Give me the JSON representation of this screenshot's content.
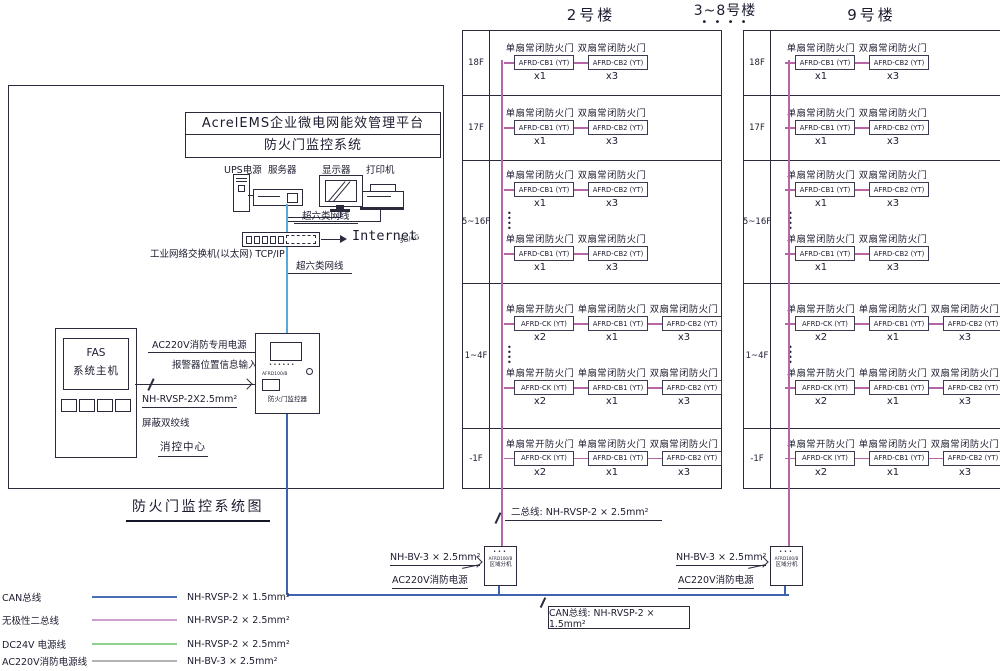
{
  "headers": {
    "building2": "2号楼",
    "building3_8": "3~8号楼",
    "building3_8_dots": "• • • •",
    "building9": "9号楼"
  },
  "platform": {
    "line1": "AcrelEMS企业微电网能效管理平台",
    "line2": "防火门监控系统"
  },
  "devices": {
    "ups": "UPS电源",
    "server": "服务器",
    "display": "显示器",
    "printer": "打印机"
  },
  "network": {
    "cat6_upper": "超六类网线",
    "cat6_lower": "超六类网线",
    "switch_label": "工业网络交换机(以太网) TCP/IP",
    "internet": "Internet",
    "cellular": "3G/4G"
  },
  "fas": {
    "line1": "FAS",
    "line2": "系统主机"
  },
  "controller": {
    "model": "AFRD100/B",
    "name": "防火门监控器"
  },
  "left_labels": {
    "ac220_dedicated": "AC220V消防专用电源",
    "alarm_input": "报警器位置信息输入",
    "cable": "NH-RVSP-2X2.5mm²",
    "shielded": "屏蔽双绞线",
    "fire_center": "消控中心",
    "diagram_title": "防火门监控系统图"
  },
  "bottom_labels": {
    "two_bus": "二总线: NH-RVSP-2 × 2.5mm²",
    "can_bus": "CAN总线: NH-RVSP-2 × 1.5mm²",
    "nh_bv": "NH-BV-3 × 2.5mm²",
    "ac220_fire": "AC220V消防电源"
  },
  "regional_unit": {
    "model": "AFRD100/B",
    "name": "区域分机"
  },
  "legend": [
    {
      "label": "CAN总线",
      "spec": "NH-RVSP-2 × 1.5mm²",
      "color": "#4a6fb5"
    },
    {
      "label": "无极性二总线",
      "spec": "NH-RVSP-2 × 2.5mm²",
      "color": "#c9a0c9"
    },
    {
      "label": "DC24V 电源线",
      "spec": "NH-RVSP-2 × 2.5mm²",
      "color": "#8fcf8f"
    },
    {
      "label": "AC220V消防电源线",
      "spec": "NH-BV-3 × 2.5mm²",
      "color": "#b3b3b3"
    }
  ],
  "colors": {
    "two_bus_wire": "#b566a6",
    "can_bus_wire": "#3f63ae",
    "cat6_wire": "#56aadc"
  },
  "buildings": [
    {
      "id": "b2"
    },
    {
      "id": "b9"
    }
  ],
  "floors": [
    {
      "label": "18F",
      "groups": [
        "closed"
      ],
      "dots": false
    },
    {
      "label": "17F",
      "groups": [
        "closed"
      ],
      "dots": false
    },
    {
      "label": "5~16F",
      "groups": [
        "closed",
        "closed"
      ],
      "dots": true
    },
    {
      "label": "1~4F",
      "groups": [
        "open_closed",
        "open_closed"
      ],
      "dots": true
    },
    {
      "label": "-1F",
      "groups": [
        "open_closed"
      ],
      "dots": false
    }
  ],
  "door_groups": {
    "closed": [
      {
        "label": "单扇常闭防火门",
        "model": "AFRD-CB1 (YT)",
        "count": "x1"
      },
      {
        "label": "双扇常闭防火门",
        "model": "AFRD-CB2 (YT)",
        "count": "x3"
      }
    ],
    "open_closed": [
      {
        "label": "单扇常开防火门",
        "model": "AFRD-CK (YT)",
        "count": "x2"
      },
      {
        "label": "单扇常闭防火门",
        "model": "AFRD-CB1 (YT)",
        "count": "x1"
      },
      {
        "label": "双扇常闭防火门",
        "model": "AFRD-CB2 (YT)",
        "count": "x3"
      }
    ]
  }
}
